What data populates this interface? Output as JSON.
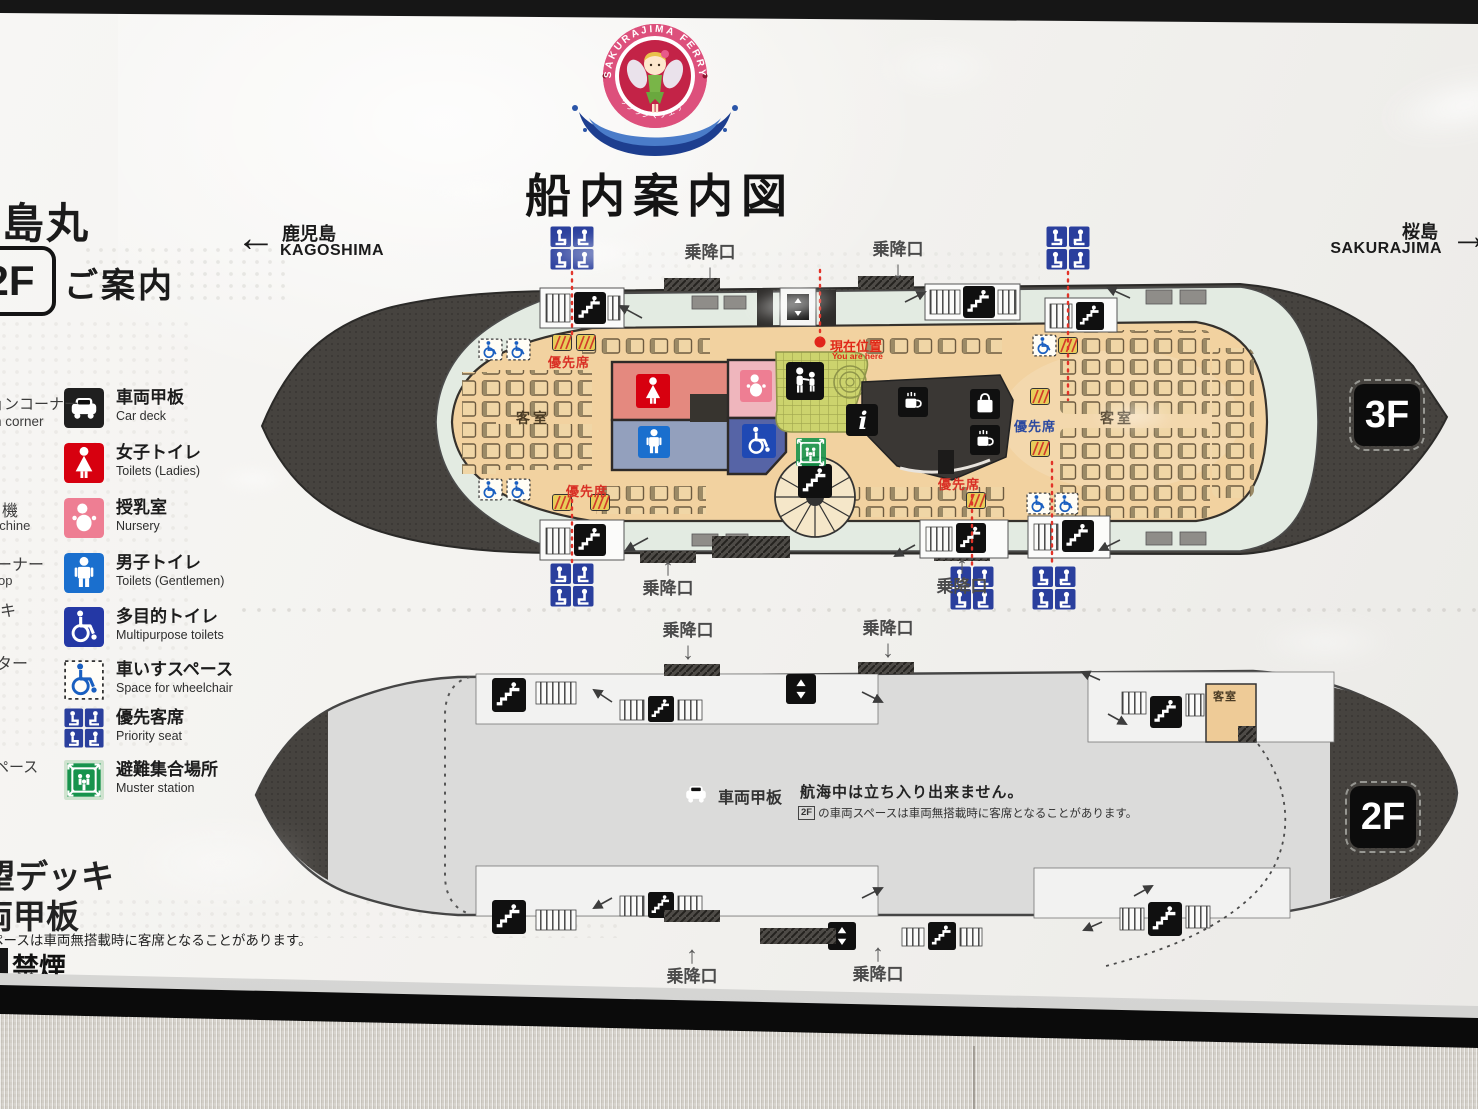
{
  "sign": {
    "title": "船内案内図",
    "logo": {
      "ring_text": "SAKURAJIMA FERRY",
      "banner_text": "サクラジマフェリー"
    },
    "ship_name": "桜島丸",
    "floor_badge": "2F",
    "guide_label": "ご案内",
    "nav": {
      "left_ja": "鹿児島",
      "left_en": "KAGOSHIMA",
      "right_ja": "桜島",
      "right_en": "SAKURAJIMA"
    }
  },
  "icons": {
    "left": "←",
    "right": "→",
    "up": "↑",
    "down": "↓"
  },
  "legend": {
    "items": [
      {
        "ja": "車両甲板",
        "en": "Car deck",
        "icon": "car-icon",
        "bg": "#1f1f1f"
      },
      {
        "ja": "女子トイレ",
        "en": "Toilets (Ladies)",
        "icon": "female-icon",
        "bg": "#d7000f"
      },
      {
        "ja": "授乳室",
        "en": "Nursery",
        "icon": "baby-icon",
        "bg": "#ee7e93"
      },
      {
        "ja": "男子トイレ",
        "en": "Toilets (Gentlemen)",
        "icon": "male-icon",
        "bg": "#1a6fce"
      },
      {
        "ja": "多目的トイレ",
        "en": "Multipurpose toilets",
        "icon": "wheelchair-icon",
        "bg": "#2438a5"
      },
      {
        "ja": "車いすスペース",
        "en": "Space for wheelchair",
        "icon": "wheelchair-space-icon",
        "bg": "#ffffff"
      },
      {
        "ja": "優先客席",
        "en": "Priority seat",
        "icon": "priority-seat-icon",
        "bg": "#2a3f9d"
      },
      {
        "ja": "避難集合場所",
        "en": "Muster station",
        "icon": "muster-icon",
        "bg": "#17934d"
      }
    ],
    "cutoff_left": [
      "ションコーナー",
      "n corner",
      "機",
      "achine",
      "ーナー",
      "op",
      "キ",
      "ター",
      "ペース"
    ],
    "cutoff_bottom": [
      "望デッキ",
      "両甲板",
      "ペースは車両無搭載時に客席となることがあります。",
      "禁煙"
    ]
  },
  "decks": {
    "boarding_label": "乗降口",
    "f3": {
      "badge": "3F",
      "cabin": "客室",
      "priority": "優先席",
      "you_are_here_ja": "現在位置",
      "you_are_here_en": "You are here"
    },
    "f2": {
      "badge": "2F",
      "cabin": "客室",
      "car_deck": "車両甲板",
      "notice_main": "航海中は立ち入り出来ません。",
      "notice_badge": "2F",
      "notice_sub": "の車両スペースは車両無搭載時に客席となることがあります。"
    }
  },
  "colors": {
    "accent_red": "#d7000f",
    "priority_blue": "#2a3f9d",
    "mint_deck": "#e3ebe2",
    "cabin_tan": "#f2d2a0",
    "muster_green": "#17934d",
    "hull_dark": "#46433f",
    "nursery_pink": "#ee7e93",
    "male_blue": "#1a6fce",
    "multipurpose_blue": "#1f49b4",
    "current_position_red": "#e02818"
  }
}
